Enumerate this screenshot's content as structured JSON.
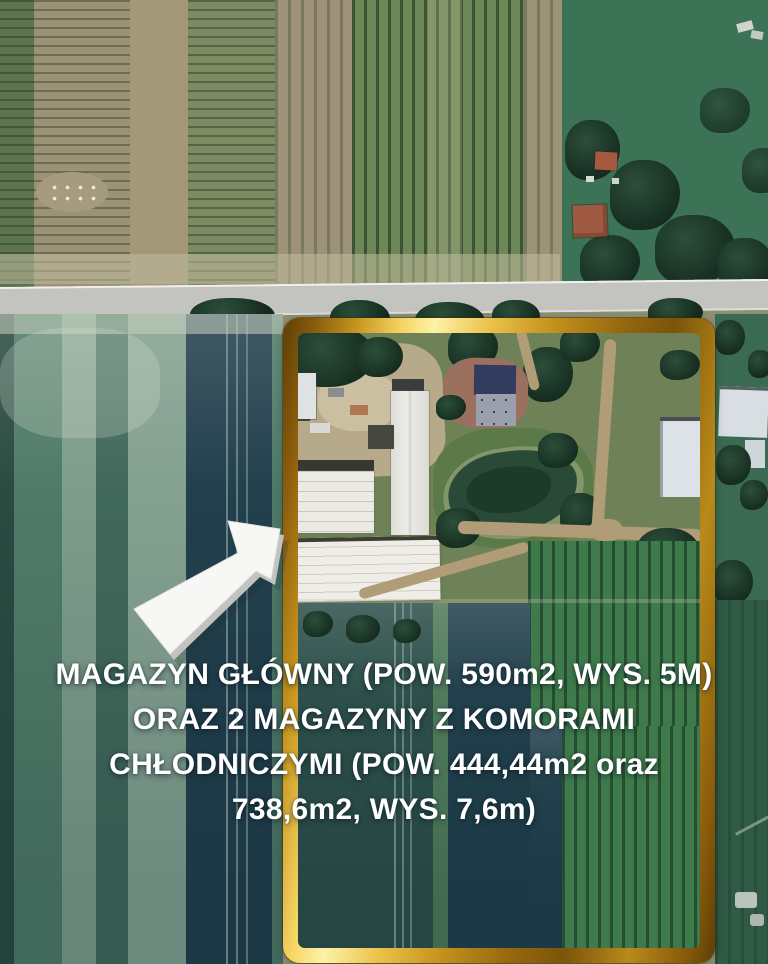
{
  "overlay": {
    "caption": {
      "lines": [
        "MAGAZYN GŁÓWNY (POW. 590m2, WYS. 5M)",
        "ORAZ 2 MAGAZYNY Z KOMORAMI",
        "CHŁODNICZYMI (POW. 444,44m2 oraz",
        "738,6m2,  WYS. 7,6m)"
      ],
      "text_color": "#ffffff"
    },
    "arrow": {
      "direction": "up-right",
      "fill": "#f7f7f5",
      "shadow": "#c2c2c0"
    },
    "highlight_frame": {
      "gold_bright": "#fdf2a8",
      "gold_mid": "#d9a62c",
      "gold_dark": "#5e3e05"
    }
  },
  "map": {
    "type": "satellite-photo",
    "palette": {
      "road": "#c3c4bf",
      "field_teal_light": "#83a090",
      "field_teal_dark": "#223f4c",
      "crop_green": "#3f7a4c",
      "soil_tan": "#9d9277",
      "tree_dark": "#1c3328",
      "warehouse_roof_white": "#eceae4",
      "house_roof_red": "#a05a42",
      "pond_water": "#1d3a2a"
    }
  }
}
